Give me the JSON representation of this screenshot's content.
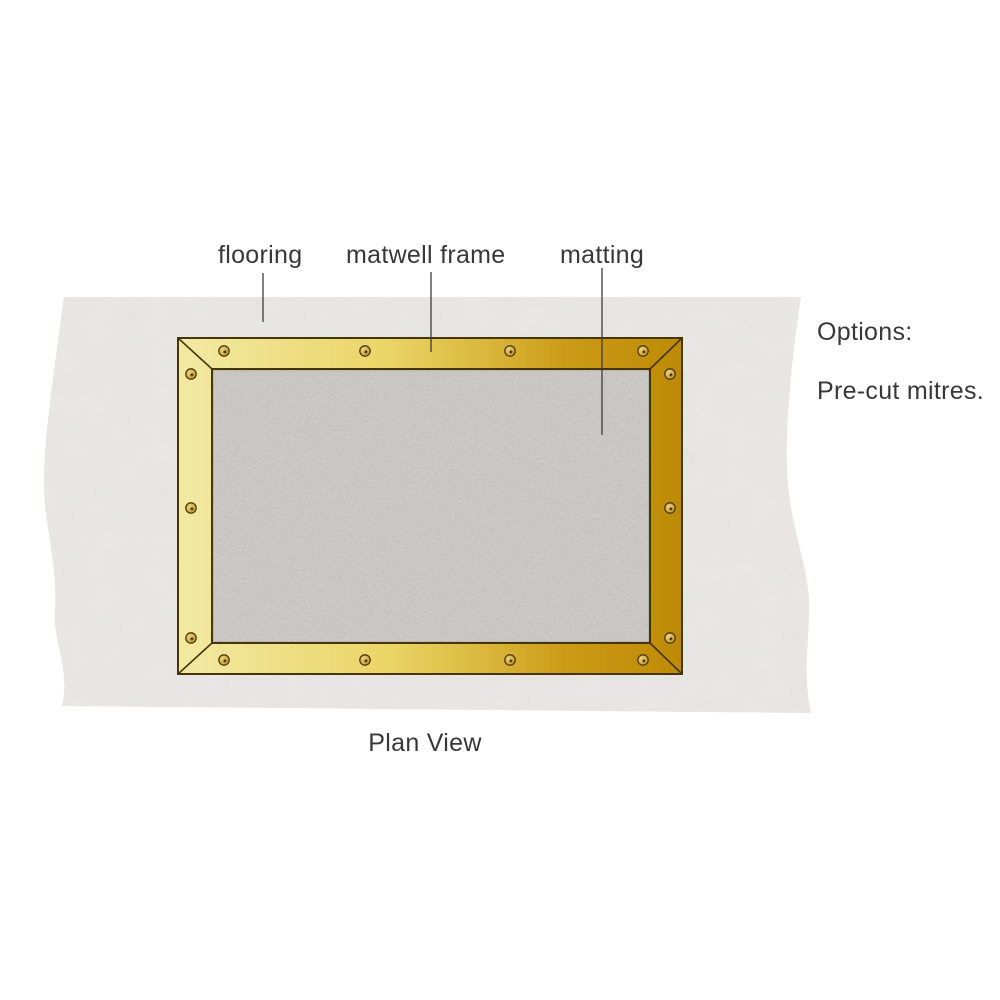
{
  "title": "Matwell frame plan view diagram",
  "labels": {
    "flooring": "flooring",
    "matwell_frame": "matwell frame",
    "matting": "matting"
  },
  "options": {
    "heading": "Options:",
    "item": "Pre-cut mitres."
  },
  "caption": "Plan View",
  "diagram": {
    "view": "plan",
    "screw_count": 14
  },
  "colors": {
    "text": "#383838",
    "leader_line": "#3c3c3c",
    "flooring_base": "#ebe9e7",
    "matting_base": "#bcb8b5",
    "frame_light": "#f2e9a4",
    "frame_mid": "#ead566",
    "frame_dark": "#cb9a15",
    "frame_darker": "#bd8a06",
    "frame_outline": "#463509",
    "screw_light": "#ecd27a",
    "screw_dark": "#bd9322",
    "screw_outline": "#4e3c0d"
  }
}
